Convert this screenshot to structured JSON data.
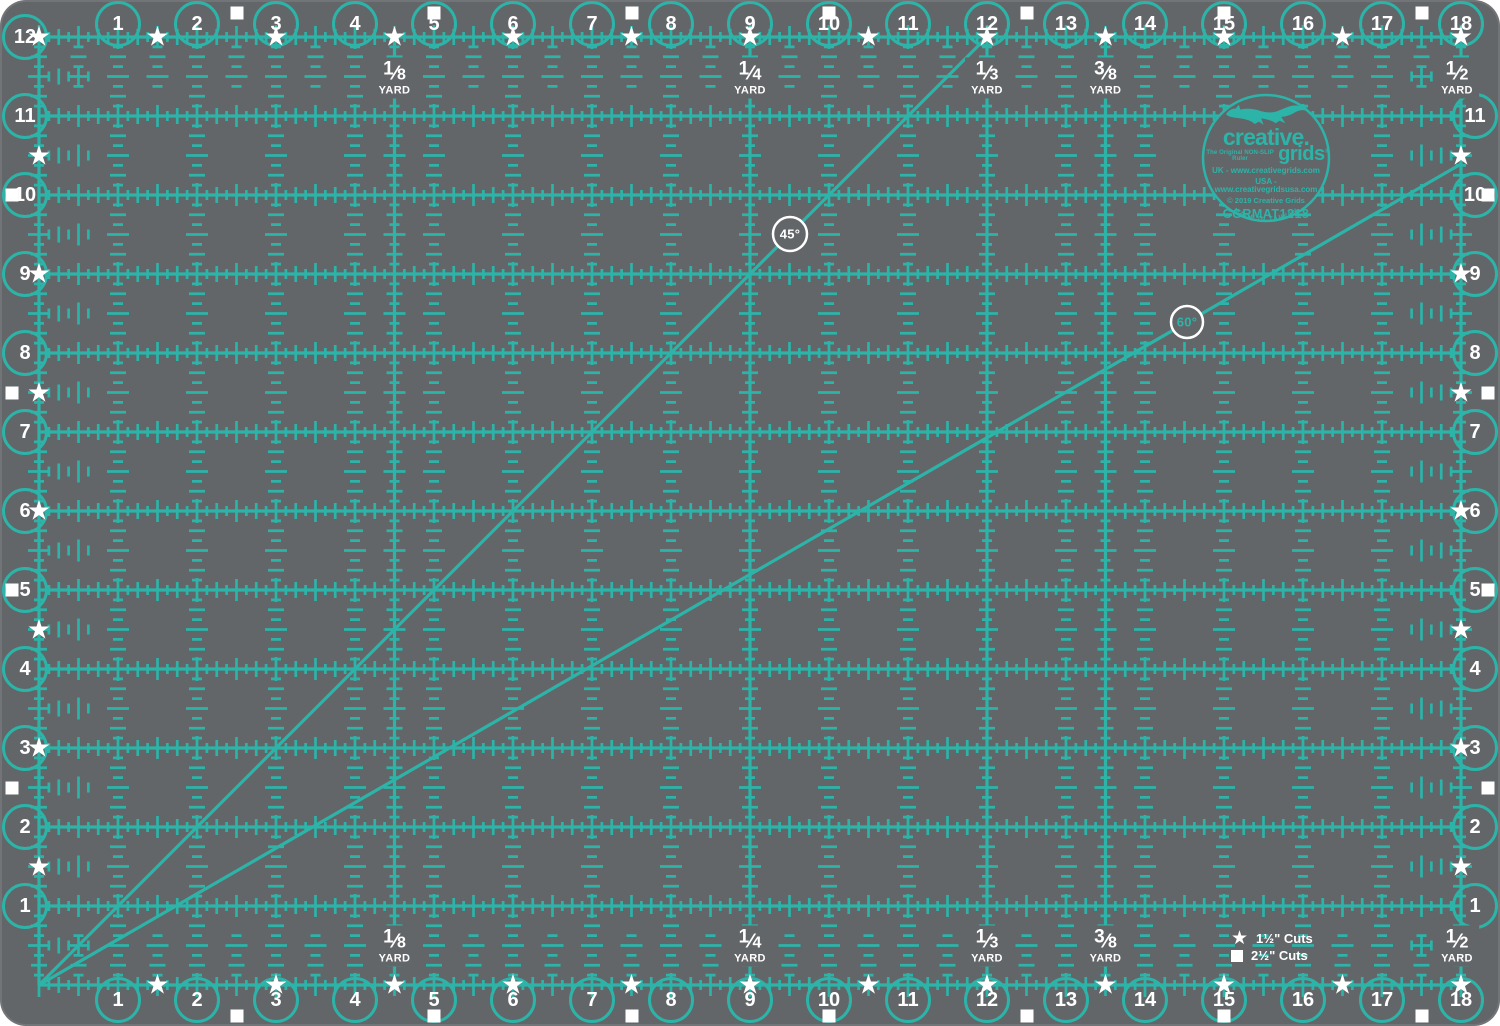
{
  "colors": {
    "mat_background": "#636669",
    "grid_teal": "#2cb4a9",
    "marker_white": "#ffffff"
  },
  "icons": {
    "star": "★",
    "square": "■"
  },
  "ruler_numbers": {
    "top": [
      "1",
      "2",
      "3",
      "4",
      "5",
      "6",
      "7",
      "8",
      "9",
      "10",
      "11",
      "12",
      "13",
      "14",
      "15",
      "16",
      "17",
      "18"
    ],
    "bottom": [
      "1",
      "2",
      "3",
      "4",
      "5",
      "6",
      "7",
      "8",
      "9",
      "10",
      "11",
      "12",
      "13",
      "14",
      "15",
      "16",
      "17",
      "18"
    ],
    "left": [
      "12",
      "11",
      "10",
      "9",
      "8",
      "7",
      "6",
      "5",
      "4",
      "3",
      "2",
      "1"
    ],
    "right": [
      "11",
      "10",
      "9",
      "8",
      "7",
      "6",
      "5",
      "4",
      "3",
      "2",
      "1"
    ]
  },
  "yard_markers": [
    {
      "numerator": "1",
      "denominator": "8",
      "unit": "YARD",
      "position_inches": 4.5
    },
    {
      "numerator": "1",
      "denominator": "4",
      "unit": "YARD",
      "position_inches": 9
    },
    {
      "numerator": "1",
      "denominator": "3",
      "unit": "YARD",
      "position_inches": 12
    },
    {
      "numerator": "3",
      "denominator": "8",
      "unit": "YARD",
      "position_inches": 13.5
    },
    {
      "numerator": "1",
      "denominator": "2",
      "unit": "YARD",
      "position_inches": 18
    }
  ],
  "angle_markers": [
    {
      "label": "45°",
      "text_color": "#ffffff"
    },
    {
      "label": "60°",
      "text_color": "#2cb4a9"
    }
  ],
  "legend": {
    "star_label": "1½\" Cuts",
    "square_label": "2½\" Cuts"
  },
  "logo": {
    "brand_top": "creative.",
    "tagline": "The Original NON-SLIP Ruler",
    "brand_bottom": "grids",
    "registered": "®",
    "uk_line": "UK - www.creativegrids.com",
    "usa_line": "USA - www.creativegridsusa.com",
    "copyright_line": "© 2019 Creative Grids",
    "model": "CGRMAT1218",
    "made_in": "MADE IN TAIWAN"
  }
}
